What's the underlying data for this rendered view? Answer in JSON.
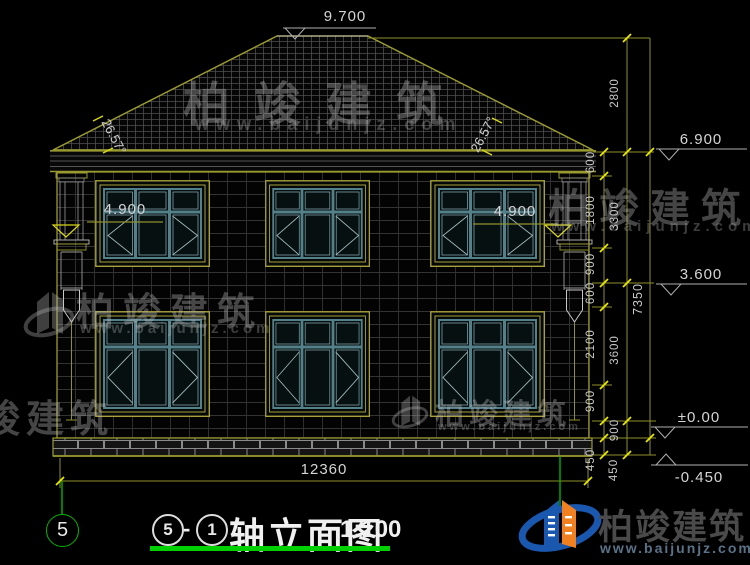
{
  "drawing": {
    "title": "轴立面图",
    "scale": "1:100",
    "axis_start": "5",
    "axis_end": "1",
    "dash": "-",
    "left_axis_bubble": "5"
  },
  "levels": {
    "ridge": "9.700",
    "eave": "6.900",
    "floor2": "3.600",
    "ground": "±0.00",
    "grade": "-0.450",
    "sill_left": "4.900",
    "sill_right": "4.900"
  },
  "dims": {
    "total_width": "12360",
    "total_height": "7350",
    "roof": "2800",
    "floor2": "3300",
    "floor1": "3600",
    "plinth": "900",
    "seg": [
      "600",
      "1800",
      "900",
      "600",
      "2100",
      "900",
      "450",
      "450"
    ],
    "slope_left": "26.57°",
    "slope_right": "26.57°"
  },
  "watermark": {
    "brand": "柏竣建筑",
    "url": "www.baijunjz.com"
  },
  "colors": {
    "line_olive": "#8f8f2e",
    "tick_yellow": "#e8e800",
    "axis_green": "#00b400",
    "title_green": "#00cf00",
    "window_teal": "#54808a",
    "frame_yellow": "#a8a03a",
    "logo_blue": "#1a58b0",
    "logo_orange": "#f08020"
  }
}
